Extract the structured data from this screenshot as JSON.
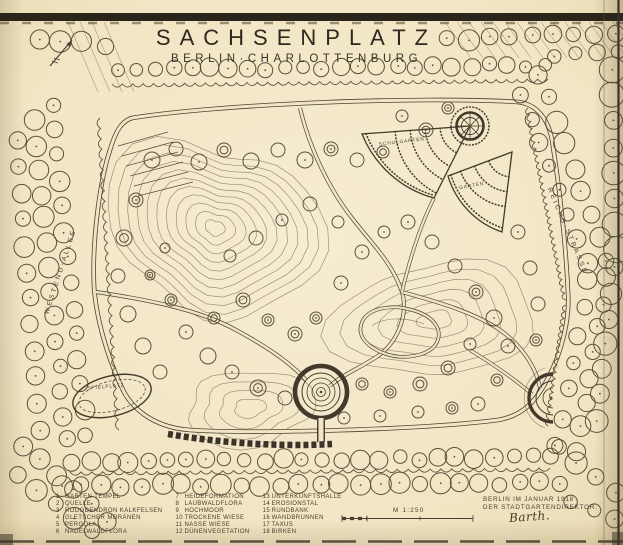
{
  "title": {
    "main": "SACHSENPLATZ",
    "subtitle": "BERLIN·CHARLOTTENBURG"
  },
  "plan": {
    "street_left": "WESTEND-ALLEE",
    "street_right": "REICHS-STRASSE",
    "label_schulgarten": "SCHULGARTEN",
    "label_garten": "GARTEN",
    "label_spielplatz": "SPIELPLATZ"
  },
  "legend": {
    "items": [
      {
        "n": "1",
        "t": "GARTEN TEMPEL"
      },
      {
        "n": "2",
        "t": "QUELLE"
      },
      {
        "n": "3",
        "t": "RODODENDRON KALKFELSEN"
      },
      {
        "n": "4",
        "t": "GLETSCHER MORÄNEN"
      },
      {
        "n": "5",
        "t": "PERGOLA"
      },
      {
        "n": "6",
        "t": "NADELWALDFLORA"
      },
      {
        "n": "7",
        "t": "HEIDEFORMATION"
      },
      {
        "n": "8",
        "t": "LAUBWALDFLORA"
      },
      {
        "n": "9",
        "t": "HOCHMOOR"
      },
      {
        "n": "10",
        "t": "TROCKENE WIESE"
      },
      {
        "n": "11",
        "t": "NASSE WIESE"
      },
      {
        "n": "12",
        "t": "DÜNENVEGETATION"
      },
      {
        "n": "13",
        "t": "UNTERKUNFTSHALLE"
      },
      {
        "n": "14",
        "t": "EROSIONSTAL"
      },
      {
        "n": "15",
        "t": "RUNDBANK"
      },
      {
        "n": "16",
        "t": "WANDBRUNNEN"
      },
      {
        "n": "17",
        "t": "TAXUS"
      },
      {
        "n": "18",
        "t": "BIRKEN"
      }
    ]
  },
  "scale": {
    "label": "M 1:250"
  },
  "imprint": {
    "line1": "BERLIN IM JANUAR 1918",
    "line2": "DER STADTGARTENDIREKTOR.",
    "signature": "Barth."
  },
  "colors": {
    "paper": "#f1e5c3",
    "ink": "#4c4236",
    "edge_band": "#2b241b"
  }
}
